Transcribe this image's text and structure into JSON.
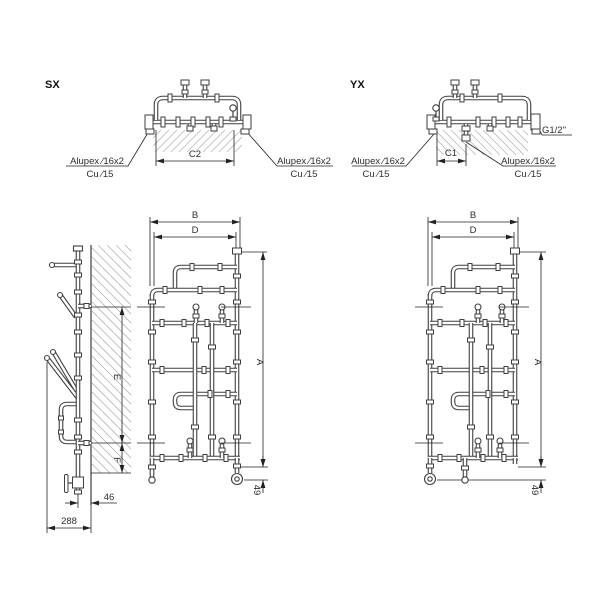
{
  "colors": {
    "pipe": "#3f3f3f",
    "dimension_lines": "#222222",
    "hatch": "#b9b9b9",
    "background": "#ffffff"
  },
  "sx": {
    "title": "SX",
    "top": {
      "span_dim": "C2",
      "left_pipe_type": "Alupex ∕16x2",
      "left_pipe_alt": "Cu ∕15",
      "right_pipe_type": "Alupex ∕16x2",
      "right_pipe_alt": "Cu ∕15"
    },
    "front": {
      "width_outer": "B",
      "width_inner": "D",
      "height": "A",
      "foot_offset": "49"
    }
  },
  "yx": {
    "title": "YX",
    "top": {
      "span_dim": "C1",
      "thread": "G1/2\"",
      "left_pipe_type": "Alupex ∕16x2",
      "left_pipe_alt": "Cu ∕15",
      "right_pipe_type": "Alupex ∕16x2",
      "right_pipe_alt": "Cu ∕15"
    },
    "front": {
      "width_outer": "B",
      "width_inner": "D",
      "height": "A",
      "foot_offset": "49"
    }
  },
  "side": {
    "upper_span": "E",
    "lower_span": "F",
    "wall_offset": "46",
    "total_depth": "288"
  }
}
